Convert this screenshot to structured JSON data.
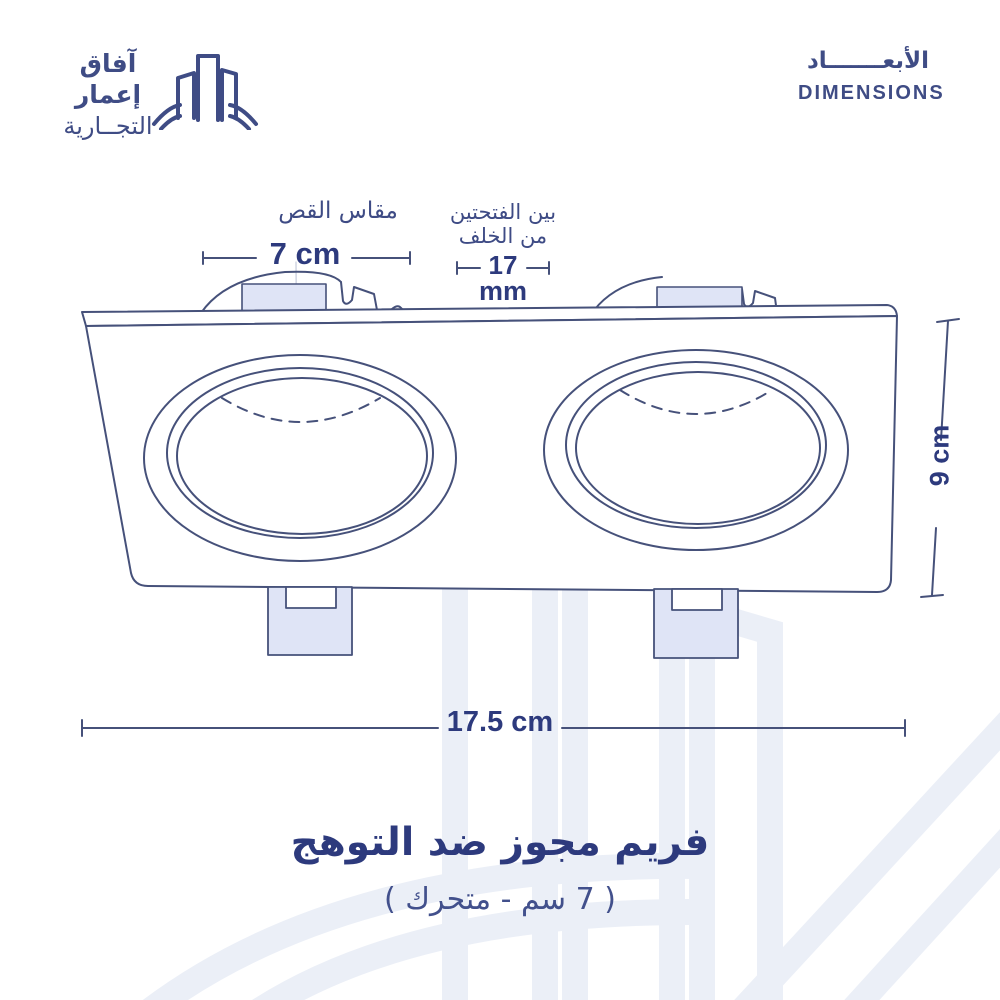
{
  "brand": {
    "logo_line1": "آفاق إعمار",
    "logo_line2": "التجــارية"
  },
  "header": {
    "title_ar": "الأبعـــــــاد",
    "title_en": "DIMENSIONS"
  },
  "annotations": {
    "cut_size_label": "مقاس القص",
    "cut_size_value": "7 cm",
    "between_holes_label_line1": "بين الفتحتين",
    "between_holes_label_line2": "من الخلف",
    "between_holes_value": "17",
    "between_holes_unit": "mm",
    "height_value": "9 cm",
    "width_value": "17.5 cm"
  },
  "product": {
    "title_ar": "فريم مجوز ضد التوهج",
    "subtitle_ar": "( 7 سم - متحرك )"
  },
  "diagram": {
    "description": "double-recessed-downlight-frame-line-drawing",
    "colors": {
      "ink": "#46517a",
      "text_navy": "#2d3a7d",
      "label_navy": "#3e4b85",
      "clip_fill": "#dfe4f6",
      "hairline": "#c9cedd",
      "watermark": "#ebeff7"
    }
  }
}
